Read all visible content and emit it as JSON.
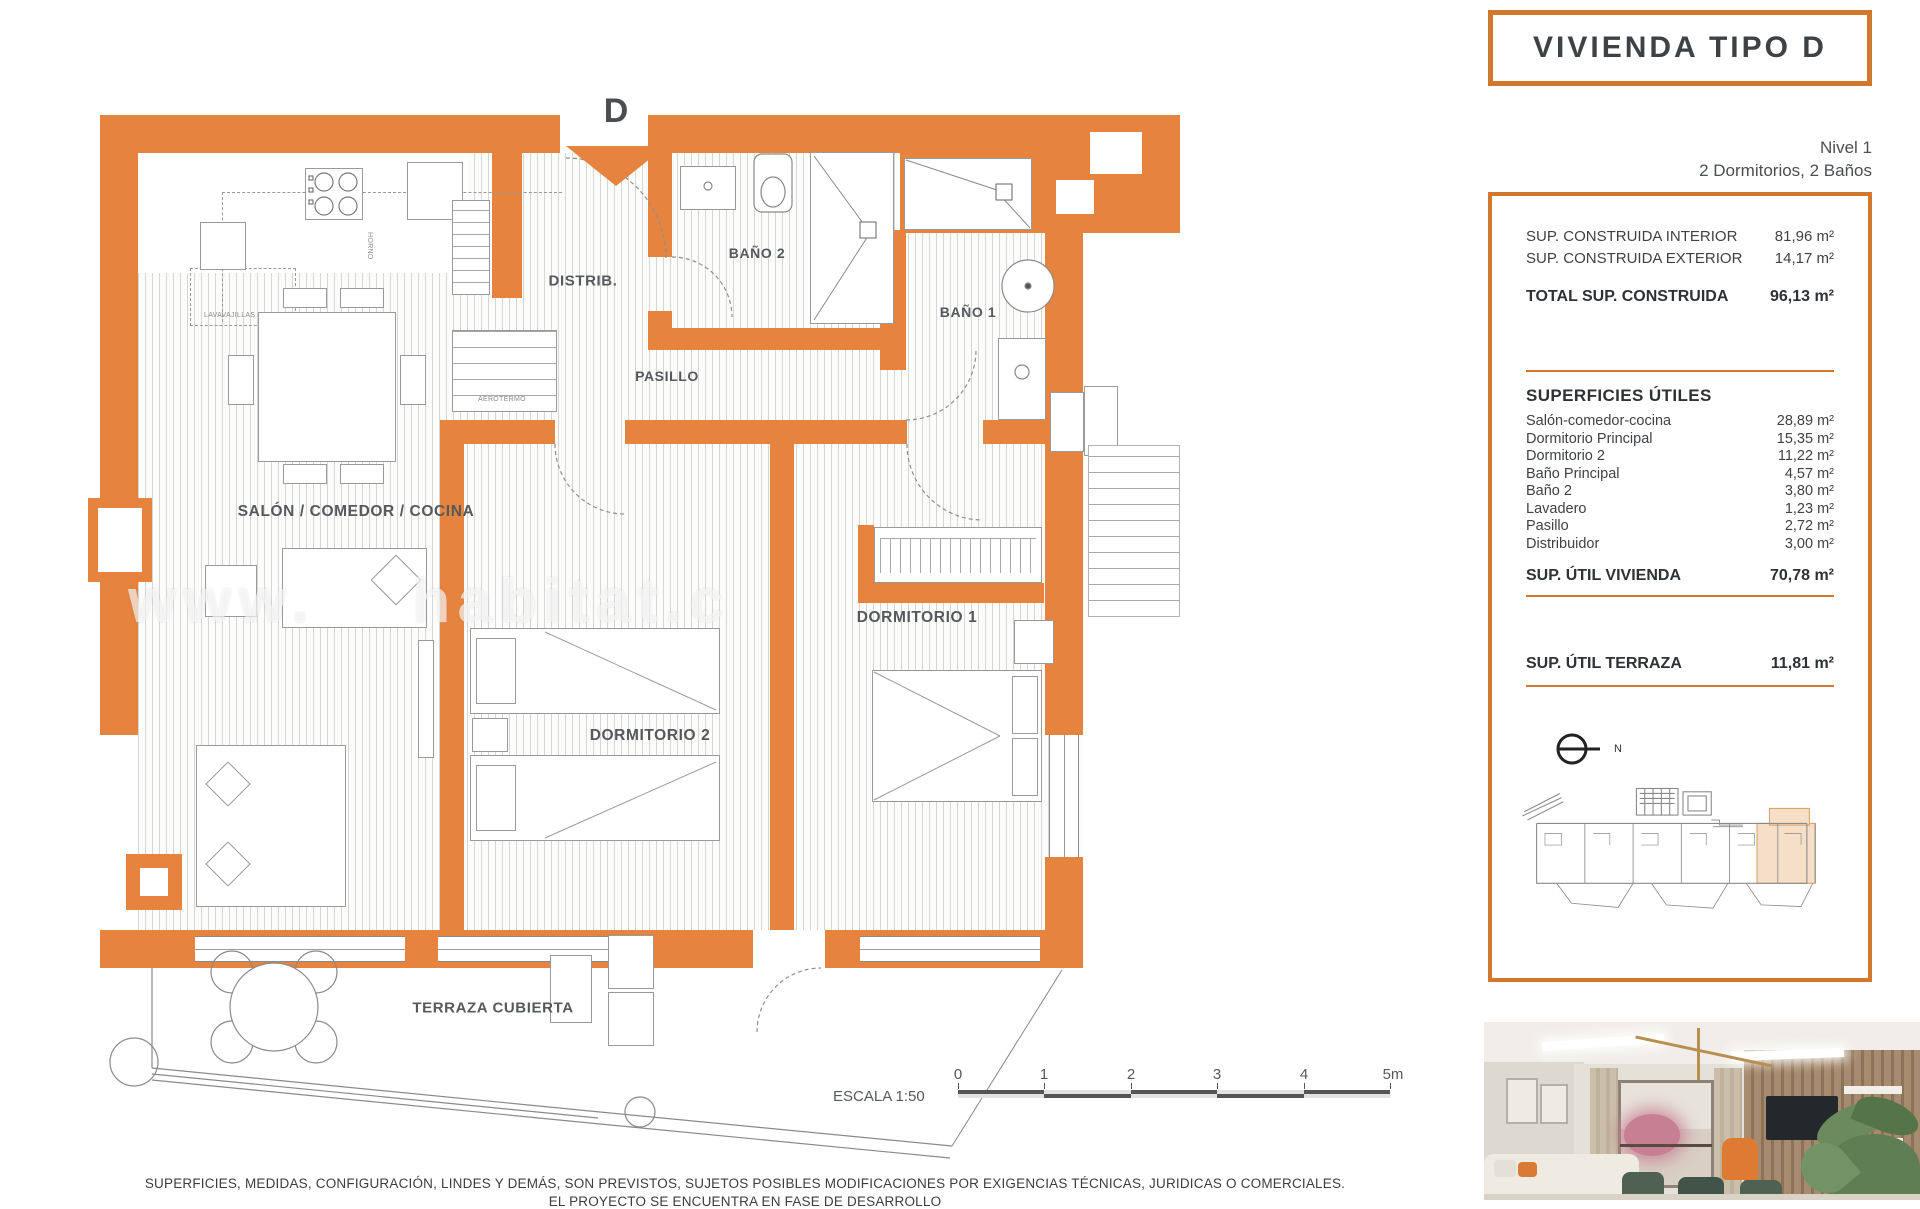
{
  "page": {
    "title_box": "VIVIENDA TIPO D",
    "level_line1": "Nivel 1",
    "level_line2": "2 Dormitorios, 2 Baños",
    "entrance_label": "D",
    "watermark": "www.    habitat.c",
    "disclaimer_line1": "SUPERFICIES, MEDIDAS, CONFIGURACIÓN, LINDES Y DEMÁS, SON PREVISTOS, SUJETOS POSIBLES MODIFICACIONES POR EXIGENCIAS TÉCNICAS, JURIDICAS O COMERCIALES.",
    "disclaimer_line2": "EL PROYECTO SE ENCUENTRA EN FASE DE DESARROLLO"
  },
  "plan": {
    "rooms": {
      "distrib": "DISTRIB.",
      "bano2": "BAÑO 2",
      "bano1": "BAÑO 1",
      "pasillo": "PASILLO",
      "salon": "SALÓN / COMEDOR / COCINA",
      "dormitorio2": "DORMITORIO 2",
      "dormitorio1": "DORMITORIO 1",
      "terraza": "TERRAZA CUBIERTA"
    },
    "micro_labels": {
      "horno": "HORNO",
      "lavavajillas": "LAVAVAJILLAS",
      "aerotermo": "AEROTERMO"
    },
    "scale": {
      "label": "ESCALA 1:50",
      "ticks": [
        "0",
        "1",
        "2",
        "3",
        "4",
        "5m"
      ]
    },
    "north_label": "N"
  },
  "panel": {
    "built": {
      "rows": [
        {
          "label": "SUP. CONSTRUIDA INTERIOR",
          "value": "81,96 m²"
        },
        {
          "label": "SUP. CONSTRUIDA EXTERIOR",
          "value": "14,17 m²"
        }
      ],
      "total_label": "TOTAL SUP. CONSTRUIDA",
      "total_value": "96,13 m²"
    },
    "usable": {
      "heading": "SUPERFICIES ÚTILES",
      "rows": [
        {
          "label": "Salón-comedor-cocina",
          "value": "28,89 m²"
        },
        {
          "label": "Dormitorio Principal",
          "value": "15,35 m²"
        },
        {
          "label": "Dormitorio 2",
          "value": "11,22 m²"
        },
        {
          "label": "Baño Principal",
          "value": "4,57 m²"
        },
        {
          "label": "Baño 2",
          "value": "3,80 m²"
        },
        {
          "label": "Lavadero",
          "value": "1,23 m²"
        },
        {
          "label": "Pasillo",
          "value": "2,72 m²"
        },
        {
          "label": "Distribuidor",
          "value": "3,00 m²"
        }
      ],
      "total_label": "SUP. ÚTIL VIVIENDA",
      "total_value": "70,78 m²"
    },
    "terrace": {
      "label": "SUP. ÚTIL TERRAZA",
      "value": "11,81 m²"
    }
  },
  "colors": {
    "wall_orange": "#E6833F",
    "border_orange": "#D2772E",
    "highlight_peach": "#F6DFC8"
  }
}
